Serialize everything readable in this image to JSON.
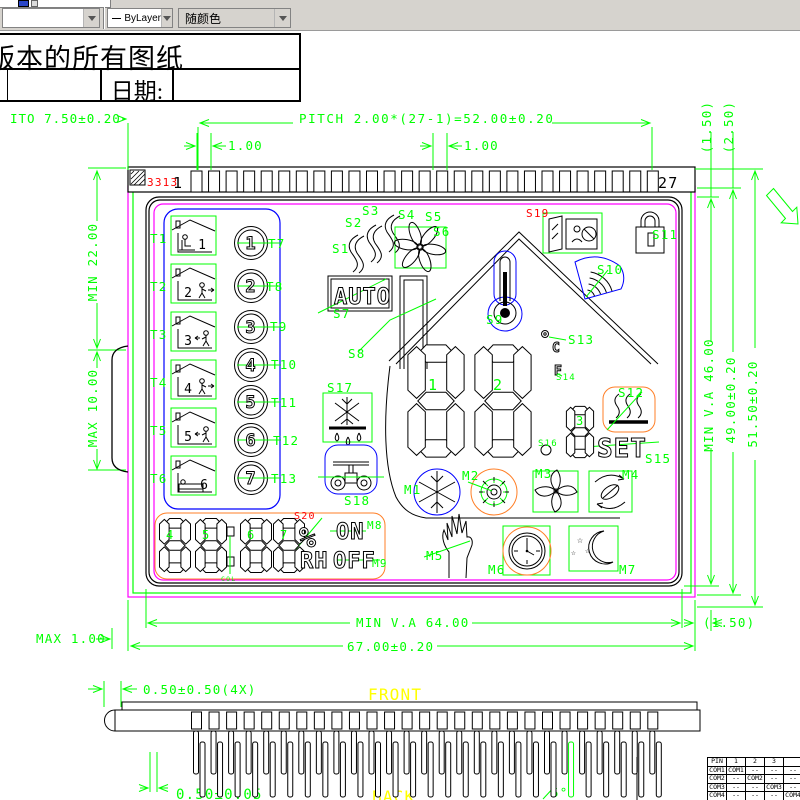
{
  "toolbar": {
    "linetype": "ByLayer",
    "color_control": "随颜色"
  },
  "title_block": {
    "title": "版本的所有图纸",
    "date_label": "日期:"
  },
  "colors": {
    "dim_green": "#00ff00",
    "magenta": "#ff00ff",
    "blue": "#0000ff",
    "orange": "#ff7f27",
    "red": "#ff0000",
    "yellow": "#ffff00"
  },
  "cad": {
    "icon_glyphs": {
      "star": "☆"
    },
    "pin_strip": {
      "count": 27,
      "x0": 191,
      "step": 17.55,
      "w": 11,
      "y": 171,
      "h": 21
    },
    "connector": {
      "stub": {
        "count": 27,
        "x0": 191.5,
        "step": 17.55,
        "w": 10,
        "y": 712,
        "h": 17
      },
      "row1": {
        "dx": 2,
        "w": 5,
        "y": 731,
        "h": 43
      },
      "row2": {
        "dx": 8.5,
        "w": 5,
        "y": 742,
        "h": 55
      },
      "green_index": 21
    },
    "digits": [
      {
        "name": "main-digit-1",
        "x": 407,
        "y": 344,
        "w": 58,
        "h": 114
      },
      {
        "name": "main-digit-2",
        "x": 474,
        "y": 344,
        "w": 58,
        "h": 114
      },
      {
        "name": "sub-digit-3",
        "x": 566,
        "y": 406,
        "w": 28,
        "h": 52
      },
      {
        "name": "rh-digit-4",
        "x": 159,
        "y": 518,
        "w": 32,
        "h": 55
      },
      {
        "name": "rh-digit-5",
        "x": 195,
        "y": 518,
        "w": 32,
        "h": 55
      },
      {
        "name": "rh-digit-6",
        "x": 240,
        "y": 518,
        "w": 32,
        "h": 55
      },
      {
        "name": "rh-digit-7",
        "x": 273,
        "y": 518,
        "w": 32,
        "h": 55
      }
    ],
    "dials": {
      "cx": 251,
      "r": 16.5,
      "items": [
        {
          "label": "1",
          "cy": 243
        },
        {
          "label": "2",
          "cy": 286
        },
        {
          "label": "3",
          "cy": 327
        },
        {
          "label": "4",
          "cy": 365
        },
        {
          "label": "5",
          "cy": 402
        },
        {
          "label": "6",
          "cy": 440
        },
        {
          "label": "7",
          "cy": 478
        }
      ]
    },
    "houses": {
      "x": 171,
      "w": 45,
      "h": 39,
      "items": [
        {
          "label": "1",
          "y": 216,
          "variant": "desk"
        },
        {
          "label": "2",
          "y": 264,
          "variant": "exit"
        },
        {
          "label": "3",
          "y": 312,
          "variant": "enter"
        },
        {
          "label": "4",
          "y": 360,
          "variant": "exit"
        },
        {
          "label": "5",
          "y": 408,
          "variant": "enter"
        },
        {
          "label": "6",
          "y": 456,
          "variant": "bed"
        }
      ]
    },
    "lcd_texts": [
      {
        "name": "auto-text",
        "text": "AUTO",
        "x": 334,
        "y": 304,
        "size": 22
      },
      {
        "name": "set-text",
        "text": "SET",
        "x": 597,
        "y": 457,
        "size": 26
      },
      {
        "name": "on-text",
        "text": "ON",
        "x": 336,
        "y": 539,
        "size": 22
      },
      {
        "name": "off-text",
        "text": "OFF",
        "x": 333,
        "y": 568,
        "size": 22
      },
      {
        "name": "rh-text",
        "text": "RH",
        "x": 300,
        "y": 568,
        "size": 22
      },
      {
        "name": "percent-text",
        "text": "%",
        "x": 299,
        "y": 547,
        "size": 28
      },
      {
        "name": "deg-c-text",
        "text": "C",
        "x": 552,
        "y": 352,
        "size": 13
      },
      {
        "name": "deg-f-text",
        "text": "F",
        "x": 554,
        "y": 375,
        "size": 13
      }
    ],
    "labels": [
      {
        "name": "dim-ito",
        "text": "ITO 7.50±0.20",
        "x": 10,
        "y": 123,
        "ls": 1
      },
      {
        "name": "dim-pitch",
        "text": "PITCH 2.00*(27-1)=52.00±0.20",
        "x": 299,
        "y": 123,
        "ls": 1.6
      },
      {
        "name": "dim-pin-gap-left",
        "text": "1.00",
        "x": 228,
        "y": 150
      },
      {
        "name": "dim-pin-gap-right",
        "text": "1.00",
        "x": 464,
        "y": 150
      },
      {
        "name": "dim-top-1-50",
        "text": "(1.50)",
        "x": 711,
        "y": 127,
        "rot": -90,
        "anchor": "middle"
      },
      {
        "name": "dim-top-2-50",
        "text": "(2.50)",
        "x": 733,
        "y": 127,
        "rot": -90,
        "anchor": "middle"
      },
      {
        "name": "chip-code",
        "text": "3313",
        "x": 147,
        "y": 186,
        "color": "#ff0000",
        "size": 11
      },
      {
        "name": "pin-number-first",
        "text": "1",
        "x": 173,
        "y": 188,
        "color": "#000000",
        "size": 15
      },
      {
        "name": "pin-number-last",
        "text": "27",
        "x": 658,
        "y": 188,
        "color": "#000000",
        "size": 15
      },
      {
        "name": "dim-min-22",
        "text": "MIN 22.00",
        "x": 97,
        "y": 262,
        "rot": -90,
        "anchor": "middle"
      },
      {
        "name": "dim-max-10",
        "text": "MAX 10.00",
        "x": 97,
        "y": 408,
        "rot": -90,
        "anchor": "middle"
      },
      {
        "name": "dim-max-1",
        "text": "MAX 1.00",
        "x": 36,
        "y": 643
      },
      {
        "name": "dim-min-va-46",
        "text": "MIN V.A 46.00",
        "x": 713,
        "y": 395,
        "rot": -90,
        "anchor": "middle"
      },
      {
        "name": "dim-49",
        "text": "49.00±0.20",
        "x": 735,
        "y": 400,
        "rot": -90,
        "anchor": "middle"
      },
      {
        "name": "dim-51-50",
        "text": "51.50±0.20",
        "x": 757,
        "y": 404,
        "rot": -90,
        "anchor": "middle"
      },
      {
        "name": "dim-min-va-64",
        "text": "MIN V.A 64.00",
        "x": 356,
        "y": 627
      },
      {
        "name": "dim-67",
        "text": "67.00±0.20",
        "x": 347,
        "y": 651
      },
      {
        "name": "dim-bottom-1-50",
        "text": "(1.50)",
        "x": 703,
        "y": 627
      },
      {
        "name": "dim-0-50-4x",
        "text": "0.50±0.50(4X)",
        "x": 143,
        "y": 694
      },
      {
        "name": "front-label",
        "text": "FRONT",
        "x": 368,
        "y": 700,
        "color": "#ffff00",
        "size": 16
      },
      {
        "name": "dim-0-50-0-05",
        "text": "0.50±0.05",
        "x": 176,
        "y": 799,
        "size": 14
      },
      {
        "name": "back-label",
        "text": "BACK",
        "x": 372,
        "y": 802,
        "color": "#ffff00",
        "size": 16
      },
      {
        "name": "dim-5-deg",
        "text": "5°",
        "x": 551,
        "y": 797
      },
      {
        "name": "label-t1",
        "text": "T1",
        "x": 150,
        "y": 243
      },
      {
        "name": "label-t2",
        "text": "T2",
        "x": 150,
        "y": 291
      },
      {
        "name": "label-t3",
        "text": "T3",
        "x": 150,
        "y": 339
      },
      {
        "name": "label-t4",
        "text": "T4",
        "x": 150,
        "y": 387
      },
      {
        "name": "label-t5",
        "text": "T5",
        "x": 150,
        "y": 435
      },
      {
        "name": "label-t6",
        "text": "T6",
        "x": 150,
        "y": 483
      },
      {
        "name": "label-t7",
        "text": "T7",
        "x": 268,
        "y": 248
      },
      {
        "name": "label-t8",
        "text": "T8",
        "x": 266,
        "y": 291
      },
      {
        "name": "label-t9",
        "text": "T9",
        "x": 270,
        "y": 331
      },
      {
        "name": "label-t10",
        "text": "T10",
        "x": 271,
        "y": 369
      },
      {
        "name": "label-t11",
        "text": "T11",
        "x": 271,
        "y": 407
      },
      {
        "name": "label-t12",
        "text": "T12",
        "x": 273,
        "y": 445
      },
      {
        "name": "label-t13",
        "text": "T13",
        "x": 271,
        "y": 483
      },
      {
        "name": "label-s1",
        "text": "S1",
        "x": 332,
        "y": 253
      },
      {
        "name": "label-s2",
        "text": "S2",
        "x": 345,
        "y": 227
      },
      {
        "name": "label-s3",
        "text": "S3",
        "x": 362,
        "y": 215
      },
      {
        "name": "label-s4",
        "text": "S4",
        "x": 398,
        "y": 219
      },
      {
        "name": "label-s5",
        "text": "S5",
        "x": 425,
        "y": 221
      },
      {
        "name": "label-s6",
        "text": "S6",
        "x": 433,
        "y": 236
      },
      {
        "name": "label-s7",
        "text": "S7",
        "x": 333,
        "y": 318
      },
      {
        "name": "label-s8",
        "text": "S8",
        "x": 348,
        "y": 358
      },
      {
        "name": "label-s9",
        "text": "S9",
        "x": 486,
        "y": 324
      },
      {
        "name": "label-s10",
        "text": "S10",
        "x": 597,
        "y": 274
      },
      {
        "name": "label-s11",
        "text": "S11",
        "x": 652,
        "y": 239
      },
      {
        "name": "label-s12",
        "text": "S12",
        "x": 618,
        "y": 397
      },
      {
        "name": "label-s13",
        "text": "S13",
        "x": 568,
        "y": 344
      },
      {
        "name": "label-s14",
        "text": "S14",
        "x": 556,
        "y": 380,
        "size": 9
      },
      {
        "name": "label-s15",
        "text": "S15",
        "x": 645,
        "y": 463
      },
      {
        "name": "label-s16",
        "text": "S16",
        "x": 538,
        "y": 446,
        "size": 9
      },
      {
        "name": "label-s17",
        "text": "S17",
        "x": 327,
        "y": 392
      },
      {
        "name": "label-s18",
        "text": "S18",
        "x": 344,
        "y": 505
      },
      {
        "name": "label-s19",
        "text": "S19",
        "x": 526,
        "y": 217,
        "color": "#ff0000",
        "size": 11
      },
      {
        "name": "label-s20",
        "text": "S20",
        "x": 294,
        "y": 519,
        "color": "#ff0000",
        "size": 10
      },
      {
        "name": "label-m1",
        "text": "M1",
        "x": 404,
        "y": 494
      },
      {
        "name": "label-m2",
        "text": "M2",
        "x": 462,
        "y": 480
      },
      {
        "name": "label-m3",
        "text": "M3",
        "x": 535,
        "y": 478
      },
      {
        "name": "label-m4",
        "text": "M4",
        "x": 622,
        "y": 479
      },
      {
        "name": "label-m5",
        "text": "M5",
        "x": 426,
        "y": 560
      },
      {
        "name": "label-m6",
        "text": "M6",
        "x": 488,
        "y": 574
      },
      {
        "name": "label-m7",
        "text": "M7",
        "x": 619,
        "y": 574
      },
      {
        "name": "label-m8",
        "text": "M8",
        "x": 367,
        "y": 529,
        "size": 11
      },
      {
        "name": "label-m9",
        "text": "M9",
        "x": 372,
        "y": 567,
        "size": 11
      },
      {
        "name": "digit-id-1",
        "text": "1",
        "x": 428,
        "y": 390,
        "size": 15
      },
      {
        "name": "digit-id-2",
        "text": "2",
        "x": 493,
        "y": 390,
        "size": 15
      },
      {
        "name": "digit-id-3",
        "text": "3",
        "x": 576,
        "y": 425,
        "size": 12
      },
      {
        "name": "digit-id-4",
        "text": "4",
        "x": 166,
        "y": 539,
        "size": 12
      },
      {
        "name": "digit-id-5",
        "text": "5",
        "x": 202,
        "y": 539,
        "size": 12
      },
      {
        "name": "digit-id-6",
        "text": "6",
        "x": 247,
        "y": 539,
        "size": 12
      },
      {
        "name": "digit-id-7",
        "text": "7",
        "x": 280,
        "y": 539,
        "size": 12
      },
      {
        "name": "label-col",
        "text": "COL",
        "x": 221,
        "y": 581,
        "size": 6.5
      }
    ],
    "pin_table": {
      "headers": [
        "PIN",
        "1",
        "2",
        "3",
        ""
      ],
      "rows": [
        [
          "COM1",
          "COM1",
          "--",
          "--",
          "--"
        ],
        [
          "COM2",
          "--",
          "COM2",
          "--",
          "--"
        ],
        [
          "COM3",
          "--",
          "--",
          "COM3",
          "--"
        ],
        [
          "COM4",
          "--",
          "--",
          "--",
          "COM4"
        ]
      ]
    }
  }
}
